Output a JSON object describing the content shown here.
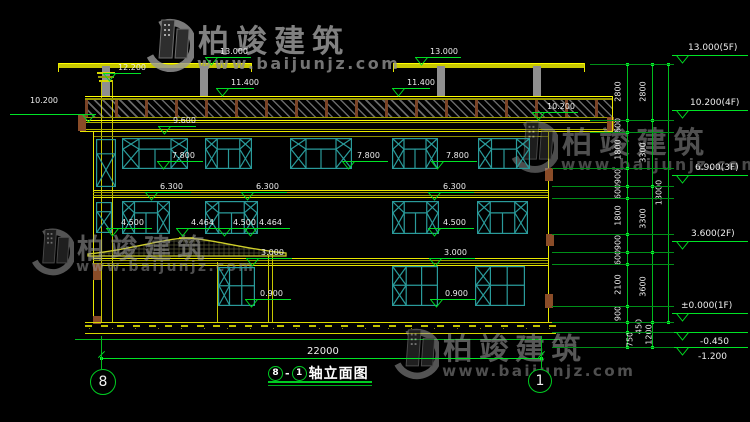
{
  "drawing_title": {
    "axis_from": "8",
    "axis_to": "1",
    "separator": "-",
    "name": "轴立面图"
  },
  "grid_bubbles": [
    {
      "label": "8",
      "x": 103,
      "y": 382,
      "r": 13
    },
    {
      "label": "1",
      "x": 540,
      "y": 381,
      "r": 12
    }
  ],
  "overall_dim": {
    "label": "22000",
    "x1": 101,
    "x2": 541,
    "y": 358
  },
  "watermarks": [
    {
      "brand": "柏竣建筑",
      "url": "www.baijunjz.com",
      "x": 140,
      "y": 16,
      "scale": 1.0,
      "opacity": 0.8
    },
    {
      "brand": "柏竣建筑",
      "url": "www.baijunjz.com",
      "x": 26,
      "y": 226,
      "scale": 0.88,
      "opacity": 0.55
    },
    {
      "brand": "柏竣建筑",
      "url": "www.baijunjz.com",
      "x": 505,
      "y": 118,
      "scale": 0.98,
      "opacity": 0.5
    },
    {
      "brand": "柏竣建筑",
      "url": "www.baijunjz.com",
      "x": 388,
      "y": 326,
      "scale": 0.95,
      "opacity": 0.55
    }
  ],
  "elevation_markers": [
    {
      "label": "13.000",
      "x": 205,
      "y": 57
    },
    {
      "label": "13.000",
      "x": 415,
      "y": 57
    },
    {
      "label": "12.200",
      "x": 103,
      "y": 73,
      "len": 38
    },
    {
      "label": "11.400",
      "x": 216,
      "y": 88,
      "len": 38
    },
    {
      "label": "11.400",
      "x": 392,
      "y": 88,
      "len": 38
    },
    {
      "label": "10.200",
      "x": 532,
      "y": 112
    },
    {
      "label": "9.600",
      "x": 158,
      "y": 126,
      "len": 38
    },
    {
      "label": "7.800",
      "x": 157,
      "y": 161
    },
    {
      "label": "7.800",
      "x": 342,
      "y": 161
    },
    {
      "label": "7.800",
      "x": 431,
      "y": 161
    },
    {
      "label": "6.300",
      "x": 145,
      "y": 192
    },
    {
      "label": "6.300",
      "x": 241,
      "y": 192
    },
    {
      "label": "6.300",
      "x": 428,
      "y": 192
    },
    {
      "label": "4.500",
      "x": 106,
      "y": 228
    },
    {
      "label": "4.464",
      "x": 176,
      "y": 228
    },
    {
      "label": "4.500",
      "x": 218,
      "y": 228
    },
    {
      "label": "4.464",
      "x": 244,
      "y": 228
    },
    {
      "label": "4.500",
      "x": 428,
      "y": 228
    },
    {
      "label": "3.000",
      "x": 246,
      "y": 258
    },
    {
      "label": "3.000",
      "x": 429,
      "y": 258
    },
    {
      "label": "0.900",
      "x": 245,
      "y": 299
    },
    {
      "label": "0.900",
      "x": 430,
      "y": 299
    }
  ],
  "left_marker": {
    "label": "10.200",
    "text_x": 30,
    "text_y": 96,
    "line_y": 114,
    "x1": 10,
    "x2": 96
  },
  "right_markers": [
    {
      "label": "13.000(5F)",
      "line_y": 55,
      "text_x": 688
    },
    {
      "label": "10.200(4F)",
      "line_y": 110,
      "text_x": 690
    },
    {
      "label": "6.900(3F)",
      "line_y": 175,
      "text_x": 695
    },
    {
      "label": "3.600(2F)",
      "line_y": 241,
      "text_x": 691
    },
    {
      "label": "±0.000(1F)",
      "line_y": 313,
      "text_x": 681
    },
    {
      "label": "-0.450",
      "line_y": 332,
      "text_x": 700,
      "text_below": true
    },
    {
      "label": "-1.200",
      "line_y": 347,
      "text_x": 698,
      "text_below": true
    }
  ],
  "dim_chains": [
    {
      "x": 627,
      "segments": [
        {
          "label": "2800",
          "y1": 64,
          "y2": 120
        },
        {
          "label": "600",
          "y1": 120,
          "y2": 132
        },
        {
          "label": "1800",
          "y1": 132,
          "y2": 168
        },
        {
          "label": "900",
          "y1": 168,
          "y2": 186
        },
        {
          "label": "600",
          "y1": 186,
          "y2": 198
        },
        {
          "label": "1800",
          "y1": 198,
          "y2": 234
        },
        {
          "label": "900",
          "y1": 234,
          "y2": 252
        },
        {
          "label": "600",
          "y1": 252,
          "y2": 264
        },
        {
          "label": "2100",
          "y1": 264,
          "y2": 306
        },
        {
          "label": "900",
          "y1": 306,
          "y2": 322
        },
        {
          "label": "450",
          "y1": 322,
          "y2": 332,
          "dx": 21
        },
        {
          "label": "750",
          "y1": 332,
          "y2": 347,
          "dx": 12
        }
      ]
    },
    {
      "x": 652,
      "segments": [
        {
          "label": "2800",
          "y1": 64,
          "y2": 120
        },
        {
          "label": "3300",
          "y1": 120,
          "y2": 186
        },
        {
          "label": "3300",
          "y1": 186,
          "y2": 252
        },
        {
          "label": "3600",
          "y1": 252,
          "y2": 322
        },
        {
          "label": "1200",
          "y1": 322,
          "y2": 347,
          "dx": 6
        }
      ]
    },
    {
      "x": 668,
      "segments": [
        {
          "label": "13000",
          "y1": 64,
          "y2": 322
        }
      ]
    }
  ],
  "ext_levels": [
    64,
    120,
    132,
    168,
    186,
    198,
    234,
    252,
    264,
    306,
    322,
    332,
    347
  ]
}
